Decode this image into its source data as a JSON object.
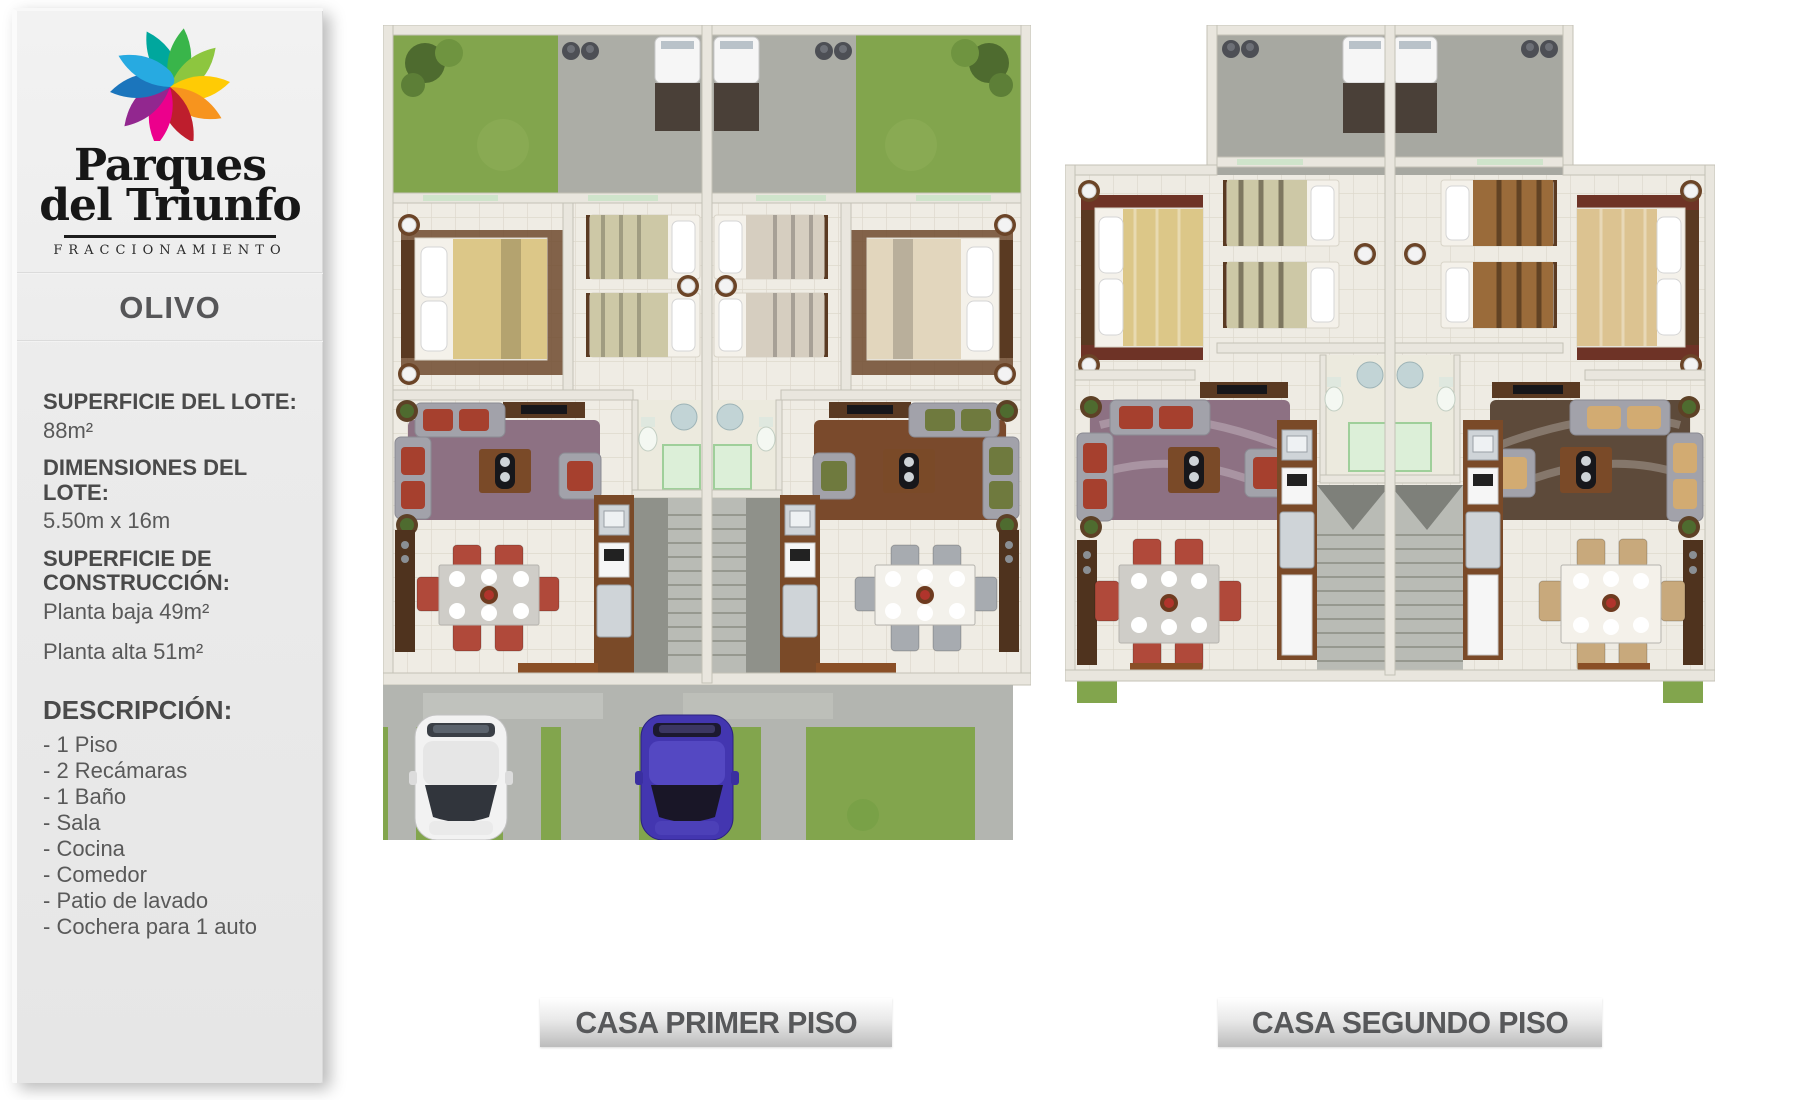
{
  "brand": {
    "name_line1": "Parques",
    "name_line2": "del Triunfo",
    "tagline": "FRACCIONAMIENTO",
    "petal_colors": [
      "#00a79d",
      "#39b54a",
      "#8dc63f",
      "#ffcb05",
      "#f7941e",
      "#be1e2d",
      "#ec008c",
      "#92278f",
      "#1b75bc",
      "#27aae1"
    ]
  },
  "model": {
    "name": "OLIVO"
  },
  "specs": {
    "lote_label": "SUPERFICIE DEL LOTE:",
    "lote_value": "88m²",
    "dim_label": "DIMENSIONES DEL LOTE:",
    "dim_value": "5.50m x 16m",
    "construccion_label": "SUPERFICIE DE CONSTRUCCIÓN:",
    "construccion_value1": "Planta baja 49m²",
    "construccion_value2": "Planta alta 51m²"
  },
  "description": {
    "title": "DESCRIPCIÓN:",
    "items": [
      "- 1 Piso",
      "- 2 Recámaras",
      "- 1 Baño",
      "- Sala",
      "- Cocina",
      "- Comedor",
      "- Patio de lavado",
      "- Cochera para 1 auto"
    ]
  },
  "captions": {
    "plan1": "CASA PRIMER PISO",
    "plan2": "CASA SEGUNDO PISO"
  },
  "palette": {
    "background": "#ffffff",
    "sidebar_bg": "#ececec",
    "heading_text": "#4a4a4a",
    "body_text": "#595959",
    "caption_text": "#57585a",
    "wall": "#e9e6de",
    "floor_tile": "#efece4",
    "grass": "#82a54d",
    "concrete": "#b3b5b0",
    "car_white": "#f2f2f2",
    "car_blue": "#4336b0",
    "shower_glass": "#cfe4cb"
  }
}
